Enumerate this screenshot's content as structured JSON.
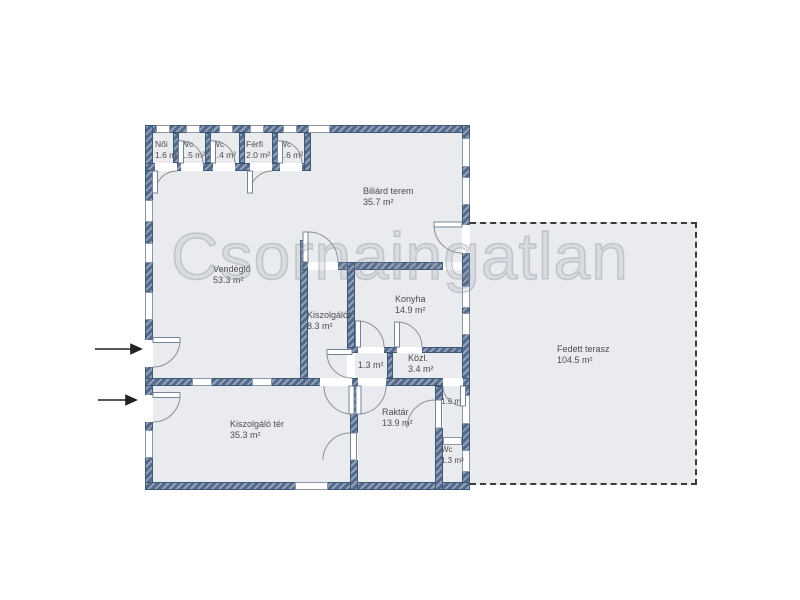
{
  "watermark": "Csornaingatlan",
  "rooms": [
    {
      "name": "Női",
      "area": "1.6 m²"
    },
    {
      "name": "Wc",
      "area": "1.5 m²"
    },
    {
      "name": "Wc",
      "area": "1.4 m²"
    },
    {
      "name": "Férfi",
      "area": "2.0 m²"
    },
    {
      "name": "Wc",
      "area": "1.6 m²"
    },
    {
      "name": "Biliárd terem",
      "area": "35.7 m²"
    },
    {
      "name": "Vendéglő",
      "area": "53.3 m²"
    },
    {
      "name": "Kiszolgálót",
      "area": "8.3 m²"
    },
    {
      "name": "Konyha",
      "area": "14.9 m²"
    },
    {
      "name": "",
      "area": "1.3 m²"
    },
    {
      "name": "Közl.",
      "area": "3.4 m²"
    },
    {
      "name": "Kiszolgáló tér",
      "area": "35.3 m²"
    },
    {
      "name": "Raktár",
      "area": "13.9 m²"
    },
    {
      "name": "",
      "area": "1.9 m²"
    },
    {
      "name": "Wc",
      "area": "1.3 m²"
    },
    {
      "name": "Fedett terasz",
      "area": "104.5 m²"
    }
  ],
  "colors": {
    "wall": "#54698a",
    "wall_light": "#93a3b8",
    "room_fill": "#e9ebee",
    "label_text": "#4c4c50",
    "terrace_border": "#3c3c3c",
    "arrow": "#222222"
  }
}
